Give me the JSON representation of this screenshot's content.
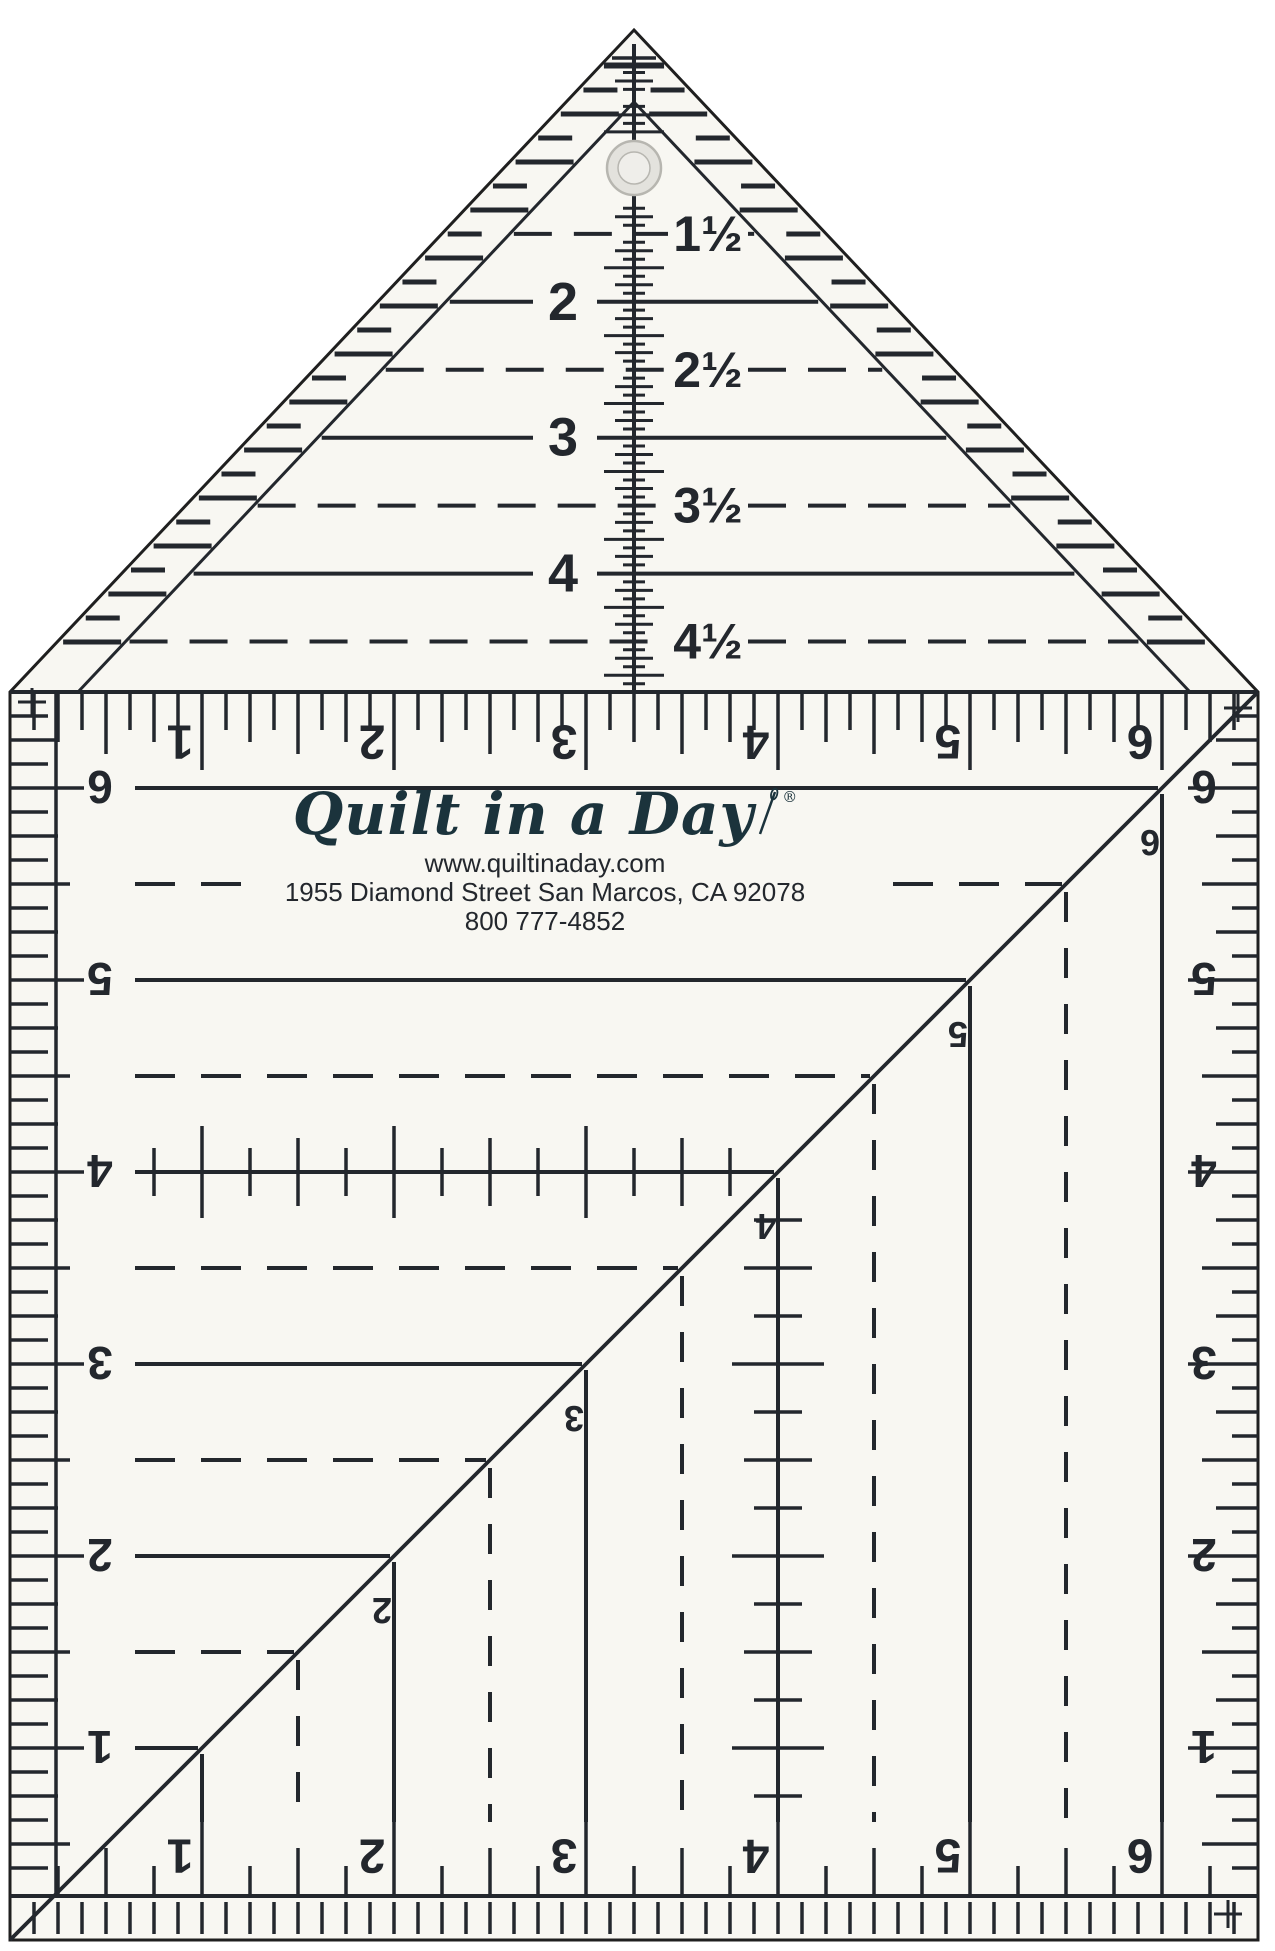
{
  "colors": {
    "ink": "#23272d",
    "surface": "#f8f7f2",
    "background": "#ffffff",
    "logo_ink": "#1b333c",
    "hole_fill": "#e3e2dd",
    "hole_rim": "#b7b6b0",
    "hole_center": "#efeeea"
  },
  "brand": {
    "logo_text": "Quilt in a Day",
    "registered_mark": "®",
    "website": "www.quiltinaday.com",
    "address_line": "1955 Diamond Street San Marcos, CA 92078",
    "phone": "800 777-4852"
  },
  "icons": {
    "hole": "hanging-hole",
    "needle": "sewing-needle-icon",
    "corner_mark": "crosshair-plus-icon"
  },
  "scales": {
    "triangle": {
      "unit": "inches",
      "labels": [
        {
          "value": "1½",
          "line": "dashed"
        },
        {
          "value": "2",
          "line": "solid"
        },
        {
          "value": "2½",
          "line": "dashed"
        },
        {
          "value": "3",
          "line": "solid"
        },
        {
          "value": "3½",
          "line": "dashed"
        },
        {
          "value": "4",
          "line": "solid"
        },
        {
          "value": "4½",
          "line": "dashed"
        }
      ]
    },
    "square": {
      "unit": "inches",
      "top_numbers": [
        "1",
        "2",
        "3",
        "4",
        "5",
        "6"
      ],
      "bottom_numbers": [
        "1",
        "2",
        "3",
        "4",
        "5",
        "6"
      ],
      "left_numbers": [
        "6",
        "5",
        "4",
        "3",
        "2",
        "1"
      ],
      "right_numbers": [
        "6",
        "5",
        "4",
        "3",
        "2",
        "1"
      ],
      "diagonal_numbers": [
        "2",
        "3",
        "4",
        "5",
        "6"
      ]
    }
  }
}
